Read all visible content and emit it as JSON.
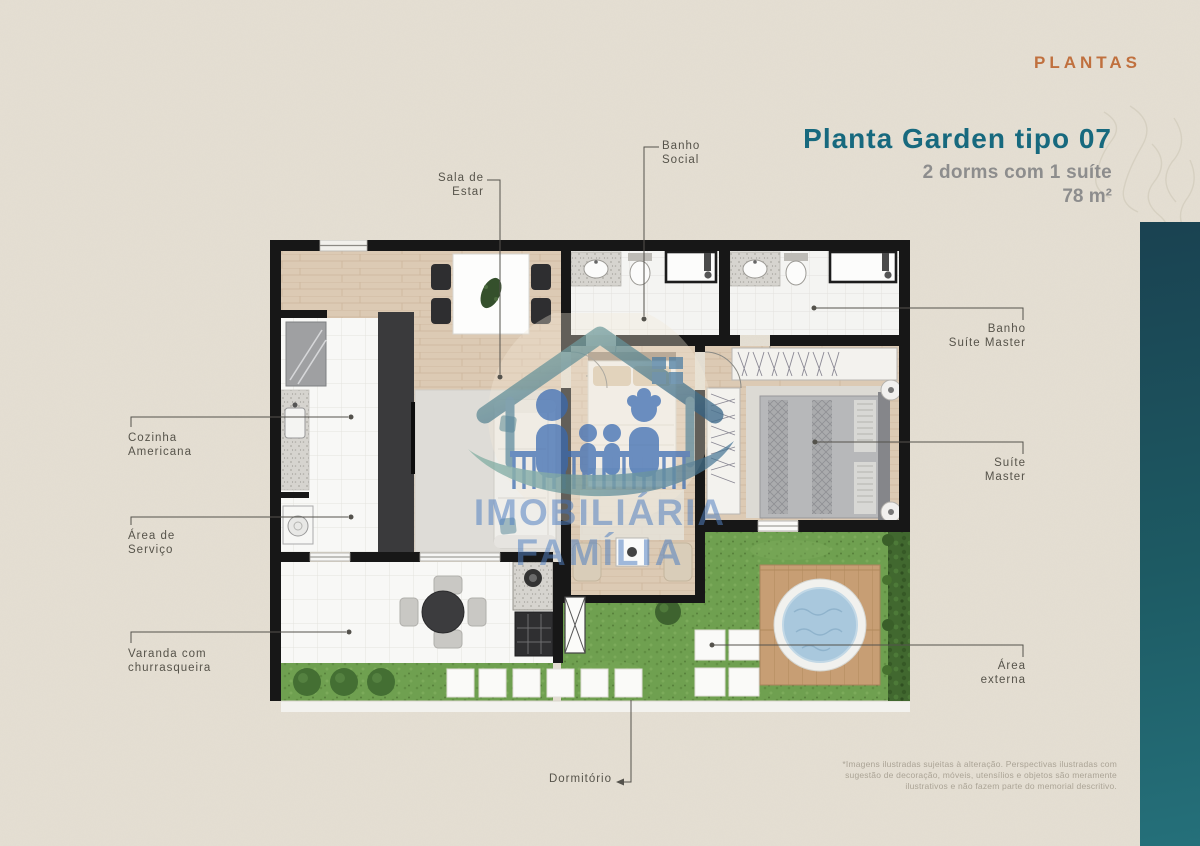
{
  "header": {
    "eyebrow": "PLANTAS"
  },
  "plan_info": {
    "title": "Planta Garden tipo 07",
    "subtitle": "2 dorms com 1 suíte",
    "area": "78 m²"
  },
  "plan_labels": [
    {
      "id": "sala-de-estar",
      "lines": [
        "Sala de",
        "Estar"
      ]
    },
    {
      "id": "banho-social",
      "lines": [
        "Banho",
        "Social"
      ]
    },
    {
      "id": "cozinha-americana",
      "lines": [
        "Cozinha",
        "Americana"
      ]
    },
    {
      "id": "area-de-servico",
      "lines": [
        "Área de",
        "Serviço"
      ]
    },
    {
      "id": "varanda-churrasqueira",
      "lines": [
        "Varanda com",
        "churrasqueira"
      ]
    },
    {
      "id": "dormitorio",
      "lines": [
        "Dormitório"
      ]
    },
    {
      "id": "banho-suite-master",
      "lines": [
        "Banho",
        "Suíte Master"
      ]
    },
    {
      "id": "suite-master",
      "lines": [
        "Suíte",
        "Master"
      ]
    },
    {
      "id": "area-externa",
      "lines": [
        "Área",
        "externa"
      ]
    }
  ],
  "watermark": {
    "line1": "IMOBILIÁRIA",
    "line2": "FAMÍLIA"
  },
  "disclaimer": {
    "lines": [
      "*Imagens ilustradas sujeitas à alteração. Perspectivas ilustradas com",
      "sugestão de decoração, móveis, utensílios e objetos são meramente",
      "ilustrativos e não fazem parte do memorial descritivo."
    ]
  },
  "colors": {
    "background_beige": "#e4ded2",
    "accent_orange": "#c0703e",
    "accent_teal": "#17697e",
    "sidebar_teal_top": "#1a4251",
    "sidebar_teal_bottom": "#25707a",
    "subtitle_gray": "#8d8d8d",
    "label_gray": "#56534a",
    "watermark_blue": "#517fc1"
  }
}
